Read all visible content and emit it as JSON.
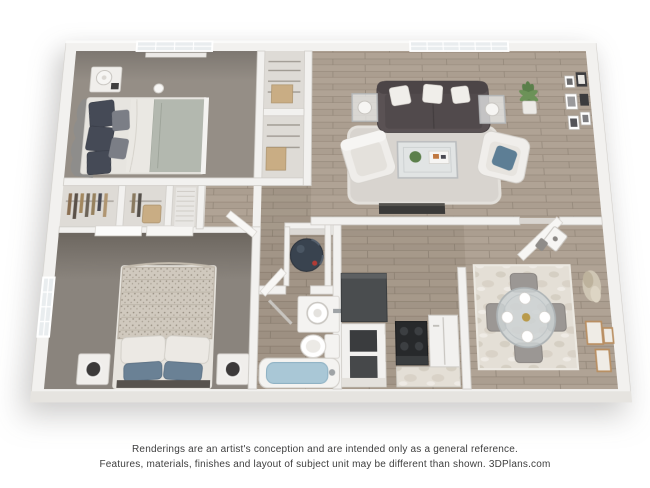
{
  "disclaimer": {
    "line1": "Renderings are an artist's conception and are intended only as a general reference.",
    "line2": "Features, materials, finishes and layout of subject unit may be different than shown. 3DPlans.com"
  },
  "floorplan": {
    "kind": "3d-rendered-floor-plan",
    "bedrooms": 2,
    "bathrooms": 1,
    "rooms": [
      {
        "id": "bedroom-1",
        "floor": "carpet",
        "color": "#958e86"
      },
      {
        "id": "bedroom-2",
        "floor": "carpet",
        "color": "#8a847d"
      },
      {
        "id": "living-room",
        "floor": "wood",
        "color": "#ab9e90"
      },
      {
        "id": "kitchen",
        "floor": "wood",
        "color": "#a4978a"
      },
      {
        "id": "dining-area",
        "floor": "wood",
        "color": "#ab9e90"
      },
      {
        "id": "bathroom",
        "floor": "wood",
        "color": "#9c8f82"
      },
      {
        "id": "hallway",
        "floor": "wood",
        "color": "#a4978a"
      },
      {
        "id": "bedroom-closets",
        "floor": "light",
        "color": "#dedbd6"
      },
      {
        "id": "pantry-closets",
        "floor": "light",
        "color": "#dedbd6"
      },
      {
        "id": "water-heater-closet",
        "floor": "light",
        "color": "#dcd9d5"
      }
    ],
    "furniture": [
      "bed",
      "nightstand",
      "lamp",
      "sofa",
      "accent-chair",
      "coffee-table",
      "end-table",
      "area-rug",
      "potted-plant",
      "gallery-frames",
      "media-console",
      "entry-door",
      "dining-table",
      "dining-chair",
      "wall-speaker",
      "wall-art",
      "range",
      "refrigerator",
      "kitchen-counter",
      "bathroom-sink",
      "toilet",
      "bathtub",
      "water-heater",
      "window"
    ],
    "palette": {
      "wall": "#f2f1ef",
      "wall_shadow": "#d2cfca",
      "sofa": "#5a5254",
      "tub_water": "#a9c7d6",
      "accent_blue": "#5d7e95",
      "plant_green": "#5a7f4a",
      "appliance_black": "#27292b",
      "frame_tan": "#b98f62",
      "accent_wall": "#6e6861",
      "text": "#3e3e3e"
    }
  }
}
